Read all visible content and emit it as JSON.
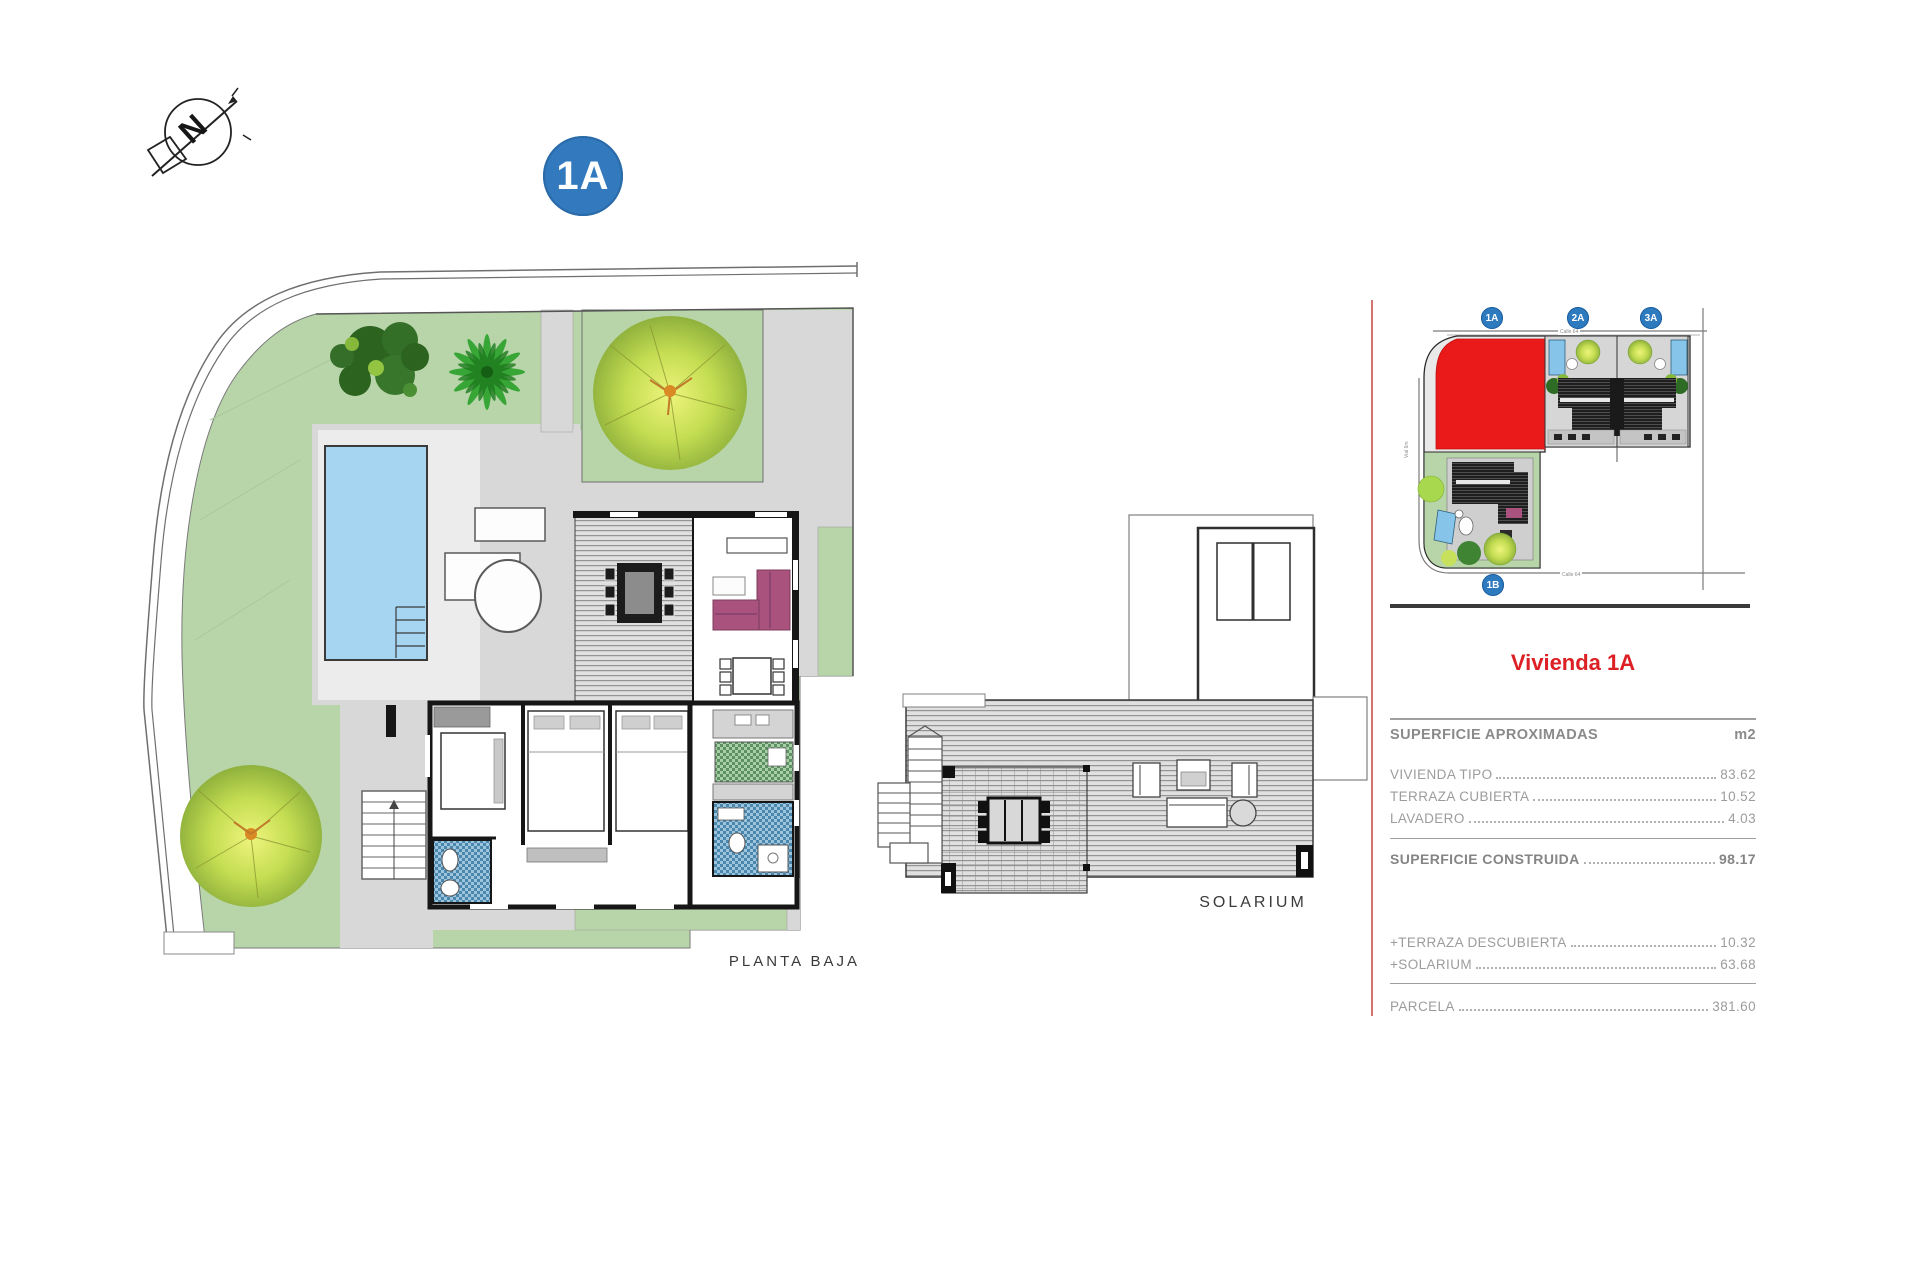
{
  "compass": {
    "north_label": "N"
  },
  "unit_badge": {
    "label": "1A",
    "color": "#3279bd"
  },
  "main_plan": {
    "caption": "PLANTA BAJA"
  },
  "solarium_plan": {
    "caption": "SOLARIUM"
  },
  "site_map": {
    "badges": [
      {
        "label": "1A"
      },
      {
        "label": "2A"
      },
      {
        "label": "3A"
      },
      {
        "label": "1B"
      }
    ],
    "streets": {
      "top": "Calle 64",
      "bottom": "Calle 64",
      "side": "Vial 6m"
    },
    "highlight_color": "#ea1a1a"
  },
  "info_panel": {
    "title": "Vivienda 1A",
    "title_color": "#dd2025",
    "table": {
      "header": {
        "label": "SUPERFICIE APROXIMADAS",
        "unit": "m2"
      },
      "rows": [
        {
          "label": "VIVIENDA TIPO",
          "value": "83.62"
        },
        {
          "label": "TERRAZA CUBIERTA",
          "value": "10.52"
        },
        {
          "label": "LAVADERO",
          "value": "4.03"
        }
      ],
      "total": {
        "label": "SUPERFICIE CONSTRUIDA",
        "value": "98.17"
      },
      "extras": [
        {
          "label": "+TERRAZA DESCUBIERTA",
          "value": "10.32"
        },
        {
          "label": "+SOLARIUM",
          "value": "63.68"
        }
      ],
      "parcel": {
        "label": "PARCELA",
        "value": "381.60"
      }
    }
  },
  "colors": {
    "lawn": "#b7d5a9",
    "pool": "#a6d5f2",
    "paving": "#d8d8d8",
    "divider_red": "#d4736f",
    "table_text": "#9c9c9c"
  }
}
